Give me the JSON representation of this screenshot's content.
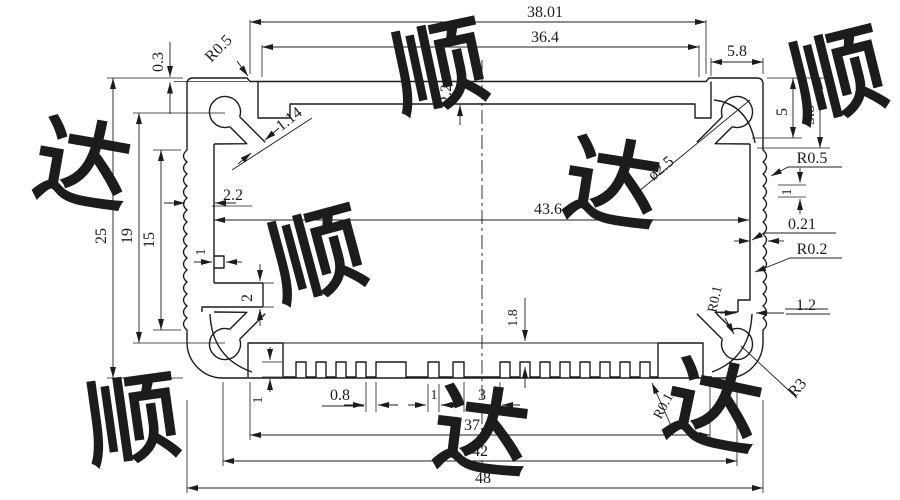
{
  "drawing": {
    "kind": "extrusion-profile-cross-section",
    "dimensions": {
      "top": {
        "width_3801": "38.01",
        "width_364": "36.4",
        "step_03": "0.3",
        "radius_tl": "R0.5",
        "wall_22": "2.2",
        "corner_58": "5.8",
        "slot_114": "1.14",
        "hole_dia": "ø2.5"
      },
      "right": {
        "h5": "5",
        "h58": "5.8",
        "r05": "R0.5",
        "pitch_1": "1",
        "depth_021": "0.21",
        "r02": "R0.2",
        "step_12": "1.2",
        "r01": "R0.1",
        "r3": "R3"
      },
      "left": {
        "h25": "25",
        "h19": "19",
        "h15": "15",
        "wall_22": "2.2",
        "step_1": "1",
        "rail_2": "2"
      },
      "middle": {
        "width_436": "43.6",
        "rib_18": "1.8"
      },
      "bottom": {
        "tooth_h1": "1",
        "gap_08": "0.8",
        "tooth_1": "1",
        "gap_3": "3",
        "w374": "37.4",
        "w42": "42",
        "w48": "48",
        "r01": "R0.1"
      }
    },
    "watermark": {
      "chars": [
        "顺",
        "达",
        "顺",
        "达",
        "顺",
        "达",
        "顺",
        "达"
      ]
    }
  }
}
